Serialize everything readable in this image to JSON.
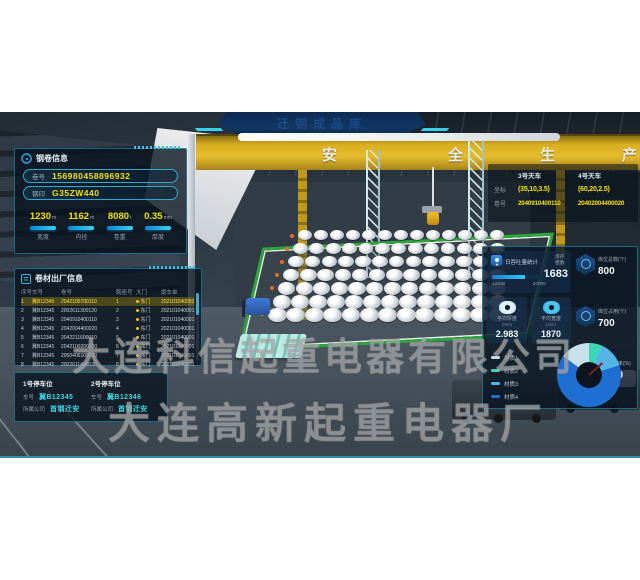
{
  "banner": {
    "title": "迁钢成品库"
  },
  "scene": {
    "slogan": [
      "安",
      "全",
      "生",
      "产"
    ]
  },
  "watermark": {
    "line1": "大连科信起重电器有限公司",
    "line2": "大连高新起重电器厂"
  },
  "coil_info": {
    "title": "钢卷信息",
    "fields": [
      {
        "label": "卷号",
        "value": "156980458896932"
      },
      {
        "label": "钢印",
        "value": "G35ZW440"
      }
    ],
    "metrics": [
      {
        "value": "1230",
        "unit": "m",
        "label": "宽度"
      },
      {
        "value": "1162",
        "unit": "m",
        "label": "内径"
      },
      {
        "value": "8080",
        "unit": "t",
        "label": "卷重"
      },
      {
        "value": "0.35",
        "unit": "mm",
        "label": "厚度"
      }
    ]
  },
  "shipment": {
    "title": "卷材出厂信息",
    "headers": [
      "序号",
      "车号",
      "卷号",
      "鞍座号",
      "大门",
      "提车单"
    ],
    "rows": [
      [
        "1",
        "冀B12345",
        "2042100700110",
        "1",
        "东门",
        "202101040001"
      ],
      [
        "2",
        "冀B12345",
        "2002611300120",
        "2",
        "东门",
        "202101040001"
      ],
      [
        "3",
        "冀B12345",
        "2040910400110",
        "3",
        "东门",
        "202101040001"
      ],
      [
        "4",
        "冀B12345",
        "2042004400020",
        "4",
        "东门",
        "202101040001"
      ],
      [
        "5",
        "冀B12345",
        "2042211600010",
        "5",
        "东门",
        "202101040001"
      ],
      [
        "6",
        "冀B12345",
        "2042100200130",
        "6",
        "东门",
        "202101040001"
      ],
      [
        "7",
        "冀B12345",
        "2050406100010",
        "7",
        "东门",
        "202101040001"
      ],
      [
        "8",
        "冀B12345",
        "2002611400030",
        "8",
        "东门",
        "202101040001"
      ]
    ]
  },
  "parking": {
    "labels": {
      "plate": "车号",
      "company": "所属公司"
    },
    "slots": [
      {
        "title": "1号停车位",
        "plate": "冀B12345",
        "company": "首钢迁安"
      },
      {
        "title": "2号停车位",
        "plate": "冀B12346",
        "company": "首钢迁安"
      }
    ]
  },
  "cranes": {
    "columns": [
      "3号天车",
      "4号天车"
    ],
    "rows": [
      {
        "label": "坐标",
        "values": [
          "(35,10,3.5)",
          "(60,20,2.5)"
        ]
      },
      {
        "label": "卷号",
        "values": [
          "2040910400110",
          "20402004400020"
        ]
      }
    ]
  },
  "stats": {
    "throughput": {
      "title": "日吞吐量统计",
      "current": 12230,
      "max": 20000,
      "count_label": "库存卷数",
      "count": "1683"
    },
    "cards": [
      {
        "label": "平均厚度",
        "unit": "(mm)",
        "value": "2.983"
      },
      {
        "label": "平均宽度",
        "unit": "(mm)",
        "value": "1870"
      }
    ],
    "kpis": [
      {
        "label": "库位总数(个)",
        "value": "800"
      },
      {
        "label": "库位占用(个)",
        "value": "700"
      },
      {
        "label": "库位占用率(%)",
        "value": "87.50"
      }
    ]
  },
  "chart_data": {
    "type": "pie",
    "labels": [
      "材质1",
      "材质2",
      "材质3",
      "材质4"
    ],
    "values": [
      15,
      7,
      13,
      65
    ],
    "colors": [
      "#c9e2ea",
      "#3ed6b8",
      "#54b4e8",
      "#1f6fd2"
    ],
    "start_angle_deg": -54,
    "legend_position": "left"
  }
}
